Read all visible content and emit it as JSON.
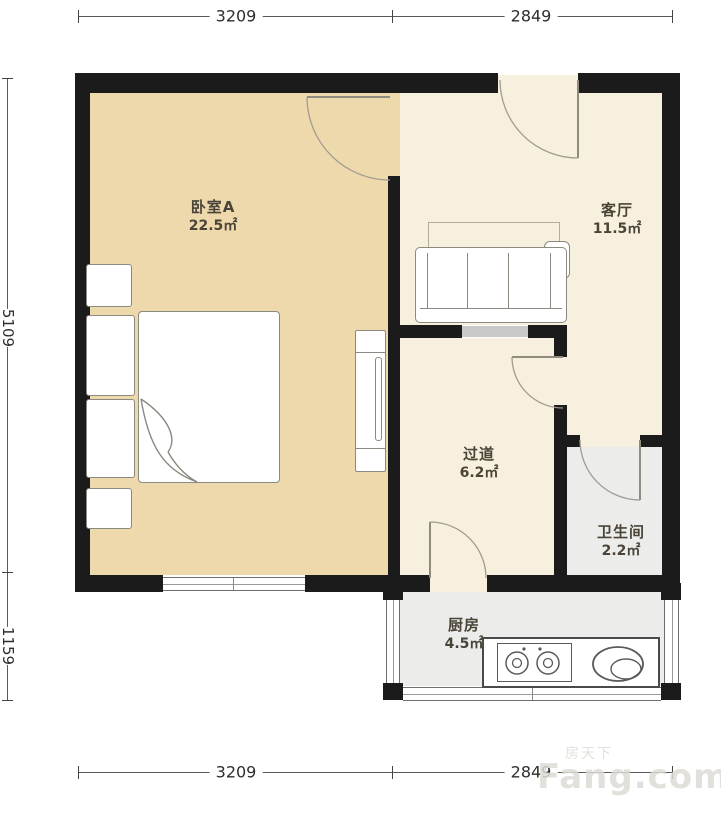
{
  "dimensions": {
    "top": [
      "3209",
      "2849"
    ],
    "bottom": [
      "3209",
      "2849"
    ],
    "left": [
      "5109",
      "1159"
    ]
  },
  "rooms": {
    "bedroom": {
      "name": "卧室A",
      "area": "22.5㎡"
    },
    "living": {
      "name": "客厅",
      "area": "11.5㎡"
    },
    "hallway": {
      "name": "过道",
      "area": "6.2㎡"
    },
    "bathroom": {
      "name": "卫生间",
      "area": "2.2㎡"
    },
    "kitchen": {
      "name": "厨房",
      "area": "4.5㎡"
    }
  },
  "watermark": {
    "brand_cn": "房天下",
    "brand_en": "Fang.com"
  },
  "colors": {
    "bedroom_floor": "#eed9ad",
    "living_floor": "#f8f0de",
    "wet_floor": "#ececeb",
    "wall": "#1b1b1b",
    "furniture_stroke": "#8a8a80"
  }
}
